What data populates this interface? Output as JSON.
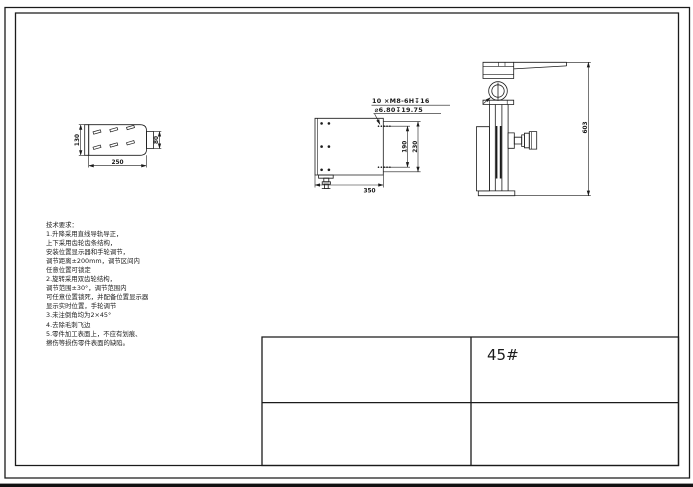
{
  "sheet": {
    "material_label": "45#"
  },
  "tech": {
    "title": "技术要求：",
    "lines": [
      "1.升降采用直线导轨导正，",
      "上下采用齿轮齿条结构，",
      "安装位置显示器和手轮调节，",
      "调节距离±200mm，调节区间内",
      "任意位置可锁定",
      "2.旋转采用双齿轮结构，",
      "调节范围±30°，调节范围内",
      "可任意位置锁死，并配备位置显示器",
      "显示实时位置，手轮调节",
      "3.未注倒角均为2×45°",
      "4.去除毛刺飞边",
      "5.零件加工表面上，不应有划痕、",
      "擦伤等损伤零件表面的缺陷。"
    ]
  },
  "views": {
    "left_view": {
      "dim_height": "130",
      "dim_width": "250",
      "dim_boss": "80"
    },
    "plan_view": {
      "callout_line1": "10 ×M8-6H↧16",
      "callout_line2": "⌀6.80↧19.75",
      "dim_span": "190",
      "dim_height": "230",
      "dim_width": "350"
    },
    "side_view": {
      "dim_height": "603"
    }
  }
}
